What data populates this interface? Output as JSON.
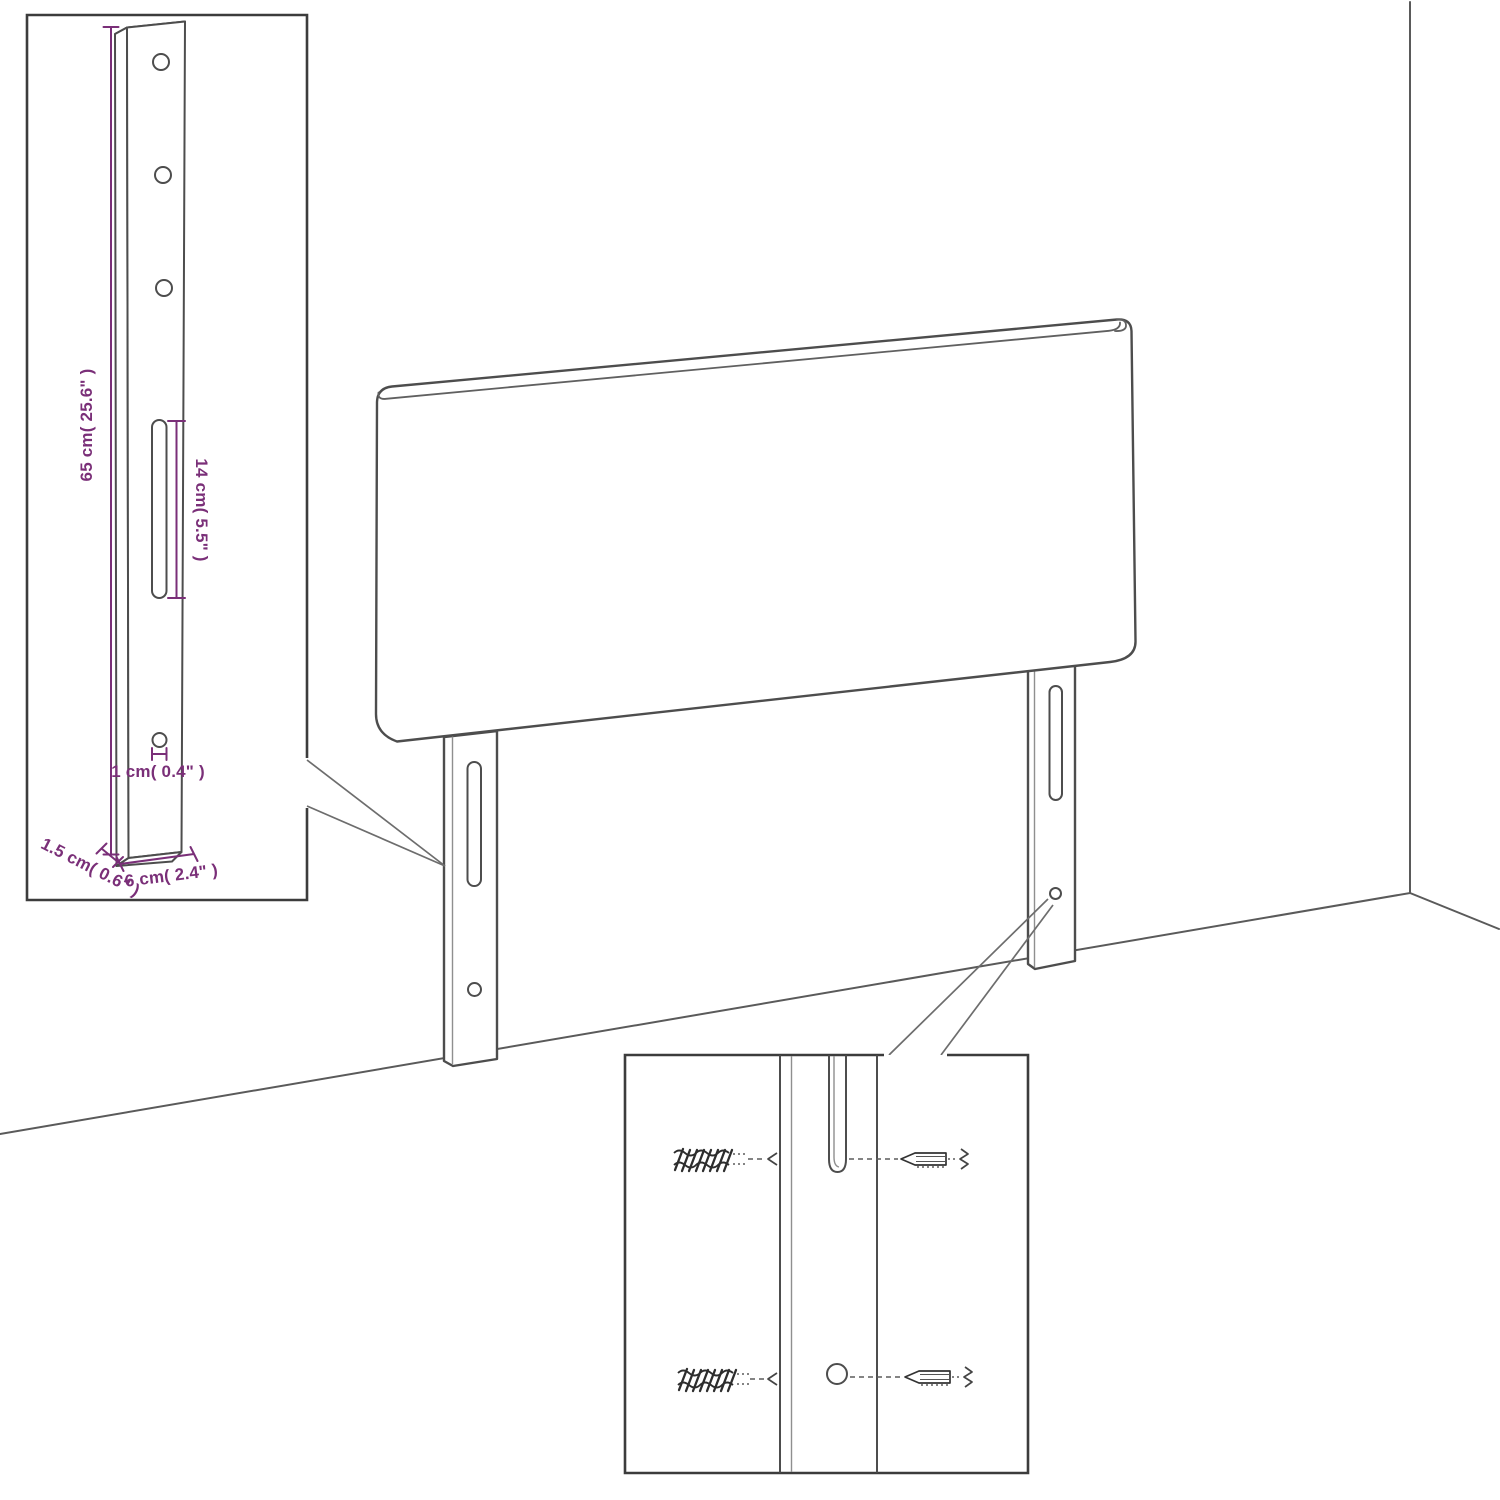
{
  "colors": {
    "dimension": "#7a2f78",
    "line_art": "#4d4d4d"
  },
  "detail_leg": {
    "height_label": "65 cm( 25.6\" )",
    "slot_label": "14 cm( 5.5\" )",
    "hole_label": "1 cm( 0.4\" )",
    "depth_label": "1.5 cm( 0.6\" )",
    "width_label": "6 cm( 2.4\" )"
  }
}
